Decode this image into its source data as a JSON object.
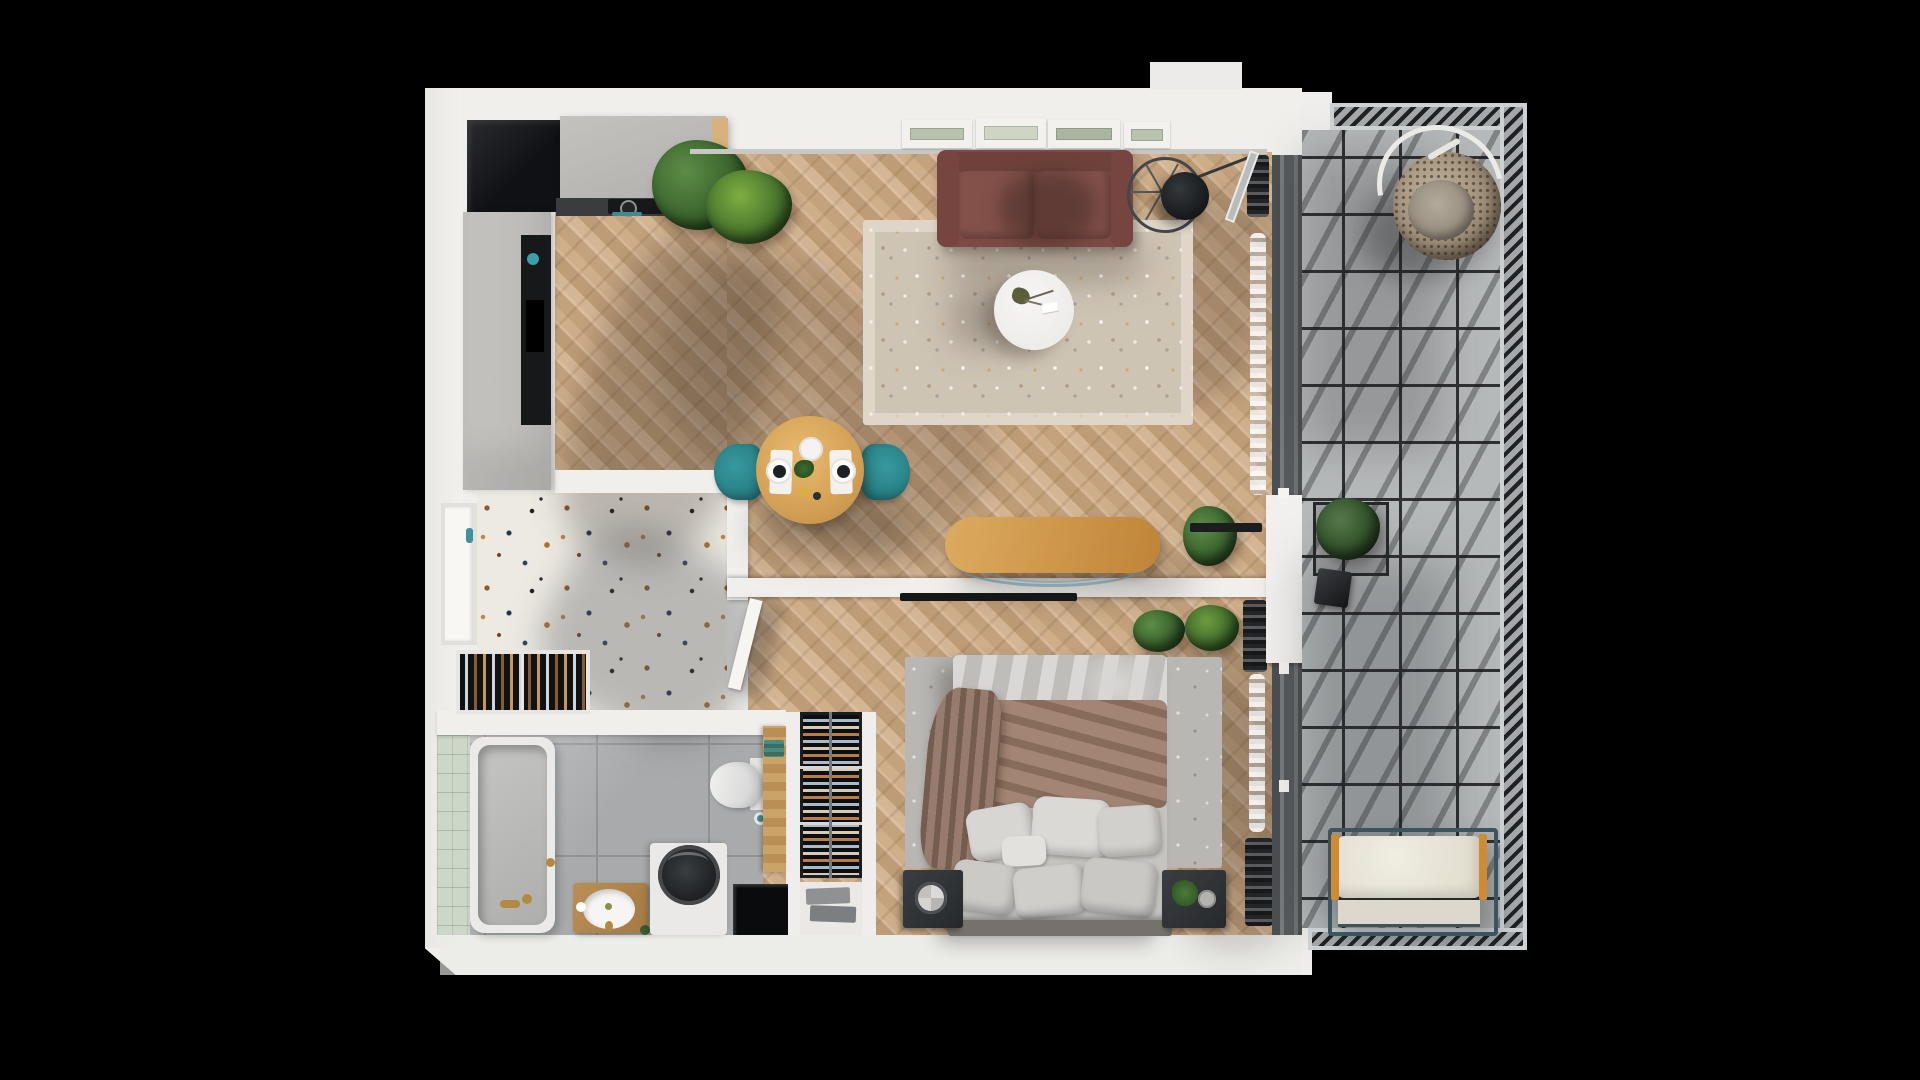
{
  "scene": {
    "type": "apartment-floor-plan-3d-render",
    "view": "top-down",
    "background": "#000000",
    "has_text": false
  },
  "palette": {
    "bg": "#000000",
    "wall": "#f0efec",
    "wood_floor": "#c9aa85",
    "terrazzo": "#edeae2",
    "bath_tile": "#a8aaab",
    "green_tile": "#ccd7c8",
    "balcony_tile": "#b6b9ba",
    "grout": "#2e3032",
    "sofa": "#7b4a42",
    "rug_beige": "#cec4b4",
    "rug_gray": "#b9b7b3",
    "teal_accent": "#2e8c92",
    "dining_table_wood": "#dca65e",
    "console_wood": "#cf9a4b",
    "blanket_brown": "#9b7c69",
    "bedding_gray": "#c9c7c4",
    "dark_furniture": "#303438",
    "bench_cushion": "#ebe7db",
    "bench_rail_orange": "#cf8a33",
    "rattan_chair": "#a79681",
    "plant_green": "#3a642d"
  },
  "rooms": [
    {
      "id": "living-room",
      "floor": "herringbone-wood"
    },
    {
      "id": "kitchen",
      "floor": "herringbone-wood"
    },
    {
      "id": "entry-hall",
      "floor": "terrazzo"
    },
    {
      "id": "bathroom",
      "floor": "gray-tile"
    },
    {
      "id": "bedroom",
      "floor": "herringbone-wood"
    },
    {
      "id": "balcony",
      "floor": "concrete-tile"
    }
  ],
  "furniture": {
    "kitchen": [
      "island-with-cooktop",
      "tall-cabinet-with-oven",
      "dark-niche-closet"
    ],
    "living_room": [
      "maroon-sofa",
      "wall-art-frames",
      "beige-rug",
      "round-coffee-table",
      "spoke-floor-lamp",
      "palm-plants",
      "dining-table",
      "teal-chair-left",
      "teal-chair-right",
      "wood-console-table",
      "potted-plant",
      "tv-bar"
    ],
    "entry_hall": [
      "entry-door",
      "entry-rack"
    ],
    "bathroom": [
      "bathtub",
      "vanity-sink",
      "washing-machine",
      "toilet",
      "wood-cabinet",
      "floor-mat"
    ],
    "bedroom": [
      "double-bed",
      "brown-blanket",
      "pillows",
      "gray-rug",
      "nightstand-left",
      "nightstand-right",
      "wall-tv",
      "shoe-rack",
      "towel-shelf",
      "potted-plants",
      "curtains",
      "radiator"
    ],
    "balcony": [
      "hanging-egg-chair",
      "planter-stand",
      "lantern",
      "bench-with-cushion",
      "railing"
    ]
  },
  "counts": {
    "pillows": 7,
    "window_frames": 4,
    "teal_chairs": 2,
    "balcony_plants": 1,
    "bedroom_plants": 2
  }
}
